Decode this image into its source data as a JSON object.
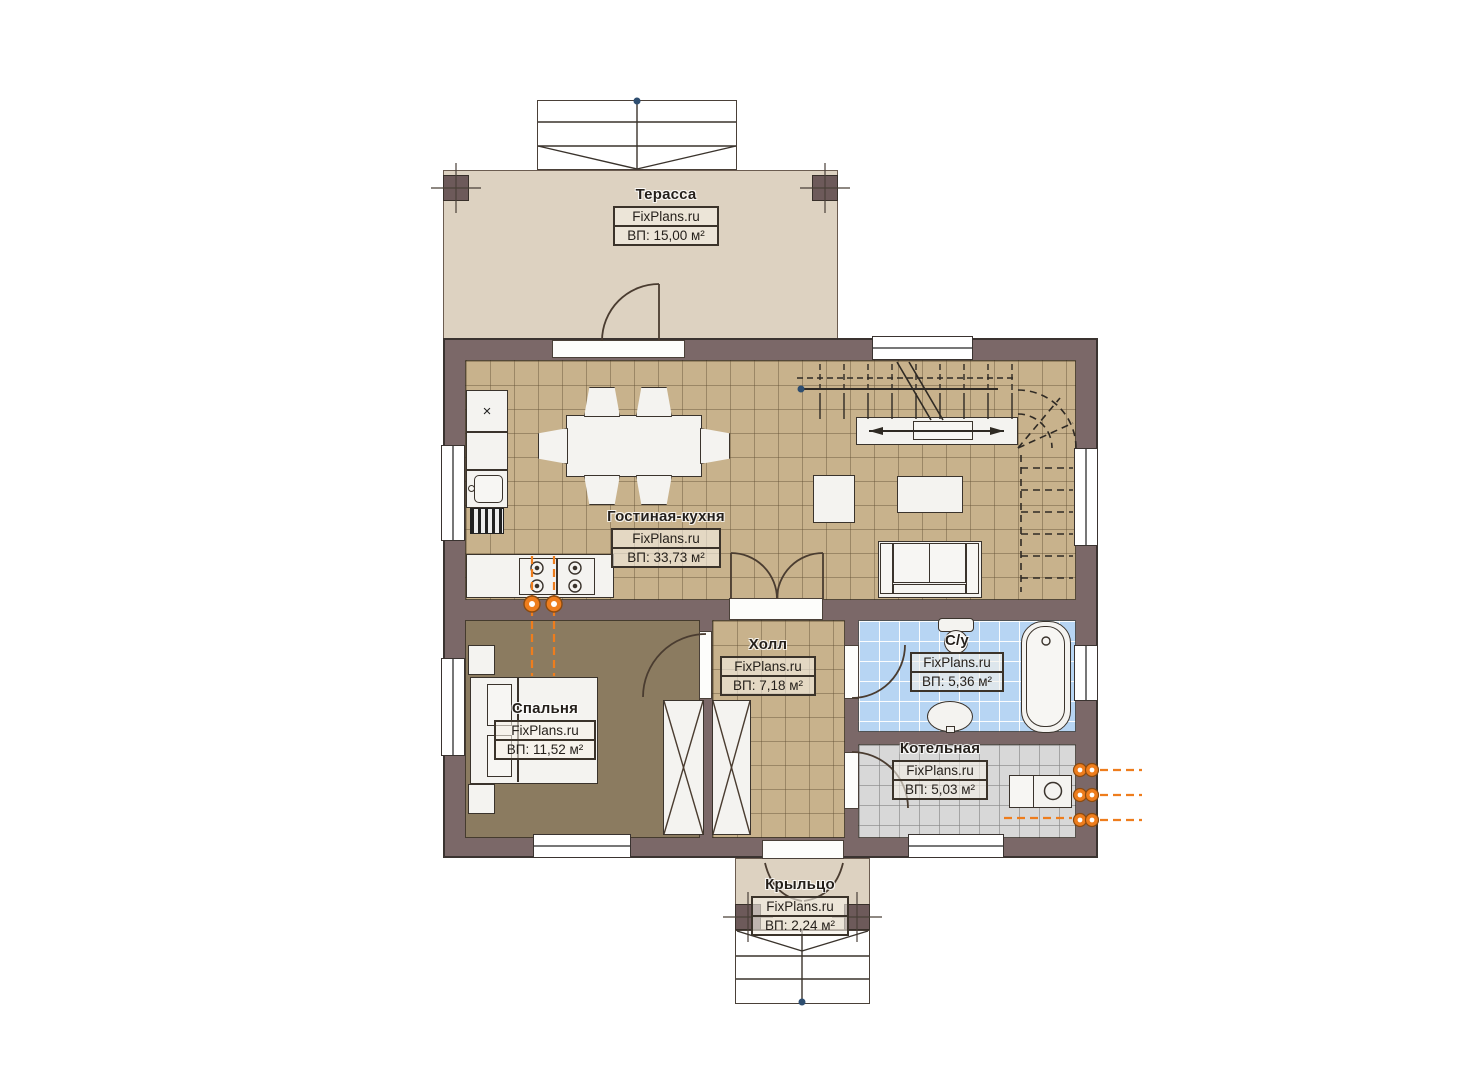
{
  "plan_title": "floor-plan",
  "watermark": "FixPlans.ru",
  "rooms": {
    "terrace": {
      "name": "Терасса",
      "brand": "FixPlans.ru",
      "area": "ВП: 15,00 м²"
    },
    "living": {
      "name": "Гостиная-кухня",
      "brand": "FixPlans.ru",
      "area": "ВП: 33,73 м²"
    },
    "hall": {
      "name": "Холл",
      "brand": "FixPlans.ru",
      "area": "ВП: 7,18 м²"
    },
    "bathroom": {
      "name": "С/у",
      "brand": "FixPlans.ru",
      "area": "ВП: 5,36 м²"
    },
    "boiler": {
      "name": "Котельная",
      "brand": "FixPlans.ru",
      "area": "ВП: 5,03 м²"
    },
    "bedroom": {
      "name": "Спальня",
      "brand": "FixPlans.ru",
      "area": "ВП: 11,52 м²"
    },
    "porch": {
      "name": "Крыльцо",
      "brand": "FixPlans.ru",
      "area": "ВП: 2,24 м²"
    }
  },
  "icons": {
    "fridge_cross": "×"
  },
  "colors": {
    "wall": "#7b6868",
    "floor_tan": "#c8b28c",
    "floor_brown": "#8b7b60",
    "tile_blue": "#b7d5f3",
    "tile_gray": "#d8d8d8",
    "deck_beige": "#ddd2c1",
    "gas_orange": "#ee7d1d",
    "marker_blue": "#2e4e70"
  }
}
